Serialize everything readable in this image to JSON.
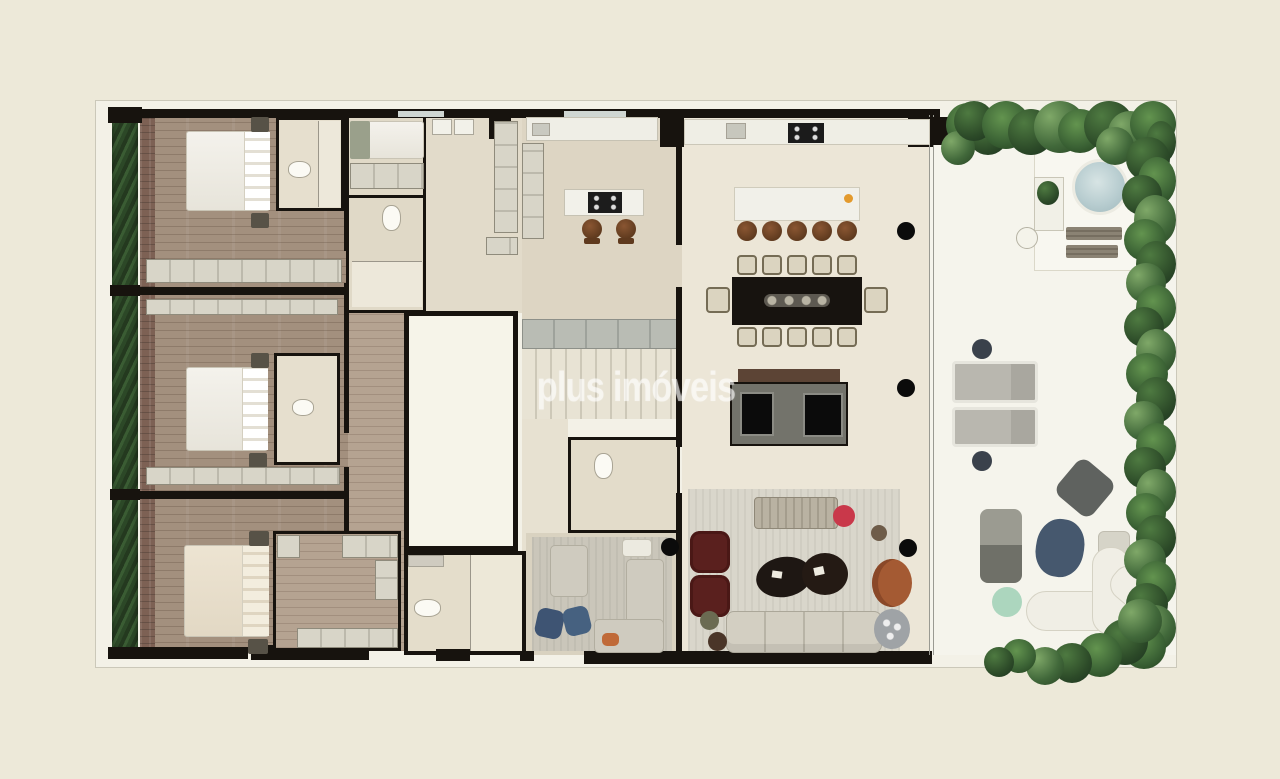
{
  "watermark": {
    "text": "plus imóveis",
    "color": "#ffffff",
    "opacity": 0.55
  },
  "plan": {
    "kind": "apartment-floor-plan-top-view",
    "counts": {
      "bedrooms": 3,
      "double_beds": 3,
      "single_beds": 1,
      "dining_seats": 12,
      "bar_stools": 5,
      "kitchen_island_stools": 2,
      "sun_loungers": 2,
      "jacuzzi": 1
    }
  },
  "palette": {
    "page_background": "#EDE9D9",
    "plan_band": "#F3F1E7",
    "walls": "#17130E",
    "wood_floor": "#A3907E",
    "beige_floor": "#DCD4C3",
    "social_floor": "#ECE6D7",
    "terrace_floor": "#F5F4EC",
    "plants_green": "#3A6134",
    "jacuzzi_blue": "#B8CDD0",
    "dining_table_black": "#17130F",
    "stool_brown": "#6F4325",
    "armchair_darkred": "#5A201E",
    "cushion_red": "#C9384A",
    "pouf_blue": "#3E5473",
    "pouf_mint": "#ACD6BE",
    "lounge_rust": "#A45A33"
  }
}
